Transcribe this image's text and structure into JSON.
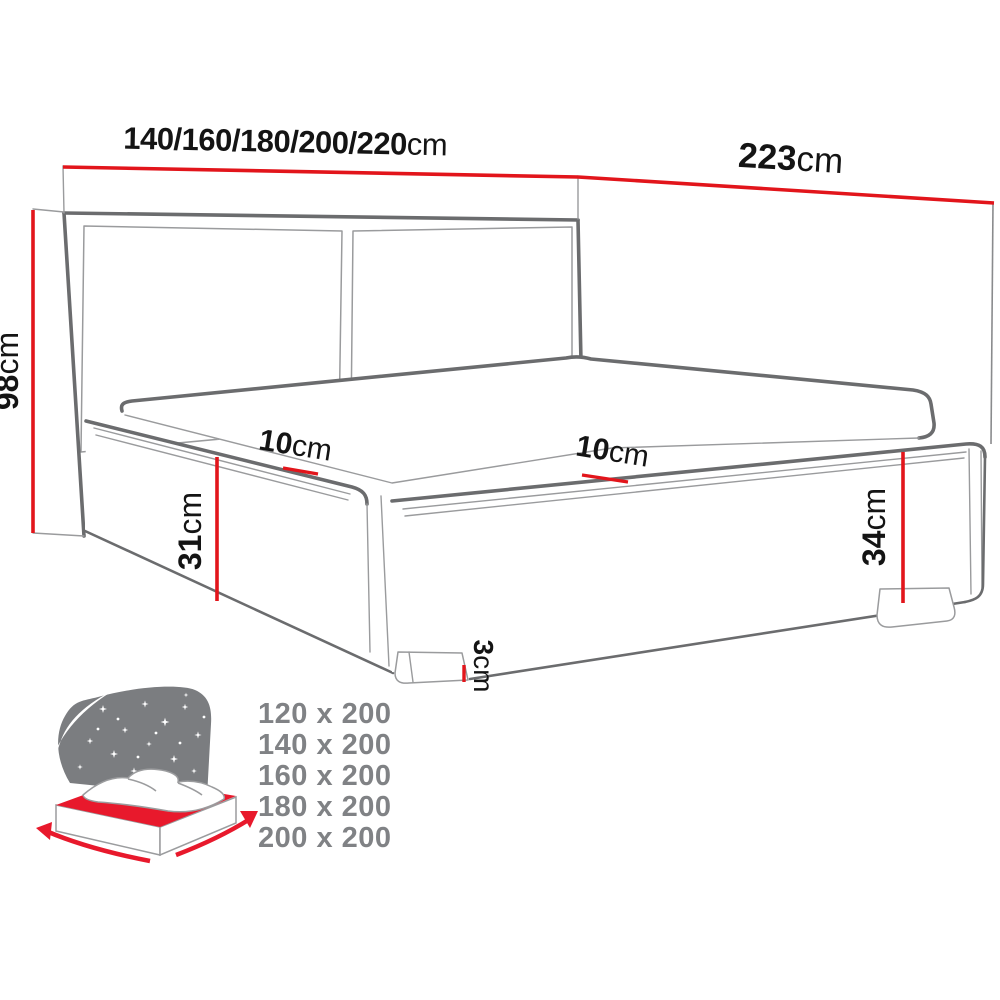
{
  "diagram": {
    "width_label": {
      "value": "140/160/180/200/220",
      "unit": "cm"
    },
    "length_label": {
      "value": "223",
      "unit": "cm"
    },
    "height_label": {
      "value": "98",
      "unit": "cm"
    },
    "front_height_label": {
      "value": "31",
      "unit": "cm"
    },
    "side_height_label": {
      "value": "34",
      "unit": "cm"
    },
    "leg_height_label": {
      "value": "3",
      "unit": "cm"
    },
    "inset_left_label": {
      "value": "10",
      "unit": "cm"
    },
    "inset_right_label": {
      "value": "10",
      "unit": "cm"
    }
  },
  "size_list": {
    "items": [
      "120 x 200",
      "140 x 200",
      "160 x 200",
      "180 x 200",
      "200 x 200"
    ]
  },
  "colors": {
    "dimension_red": "#e2151b",
    "outline_gray": "#6b6c6e",
    "muted_gray": "#808285",
    "icon_gray": "#7b7d80",
    "icon_red": "#e8192c"
  }
}
